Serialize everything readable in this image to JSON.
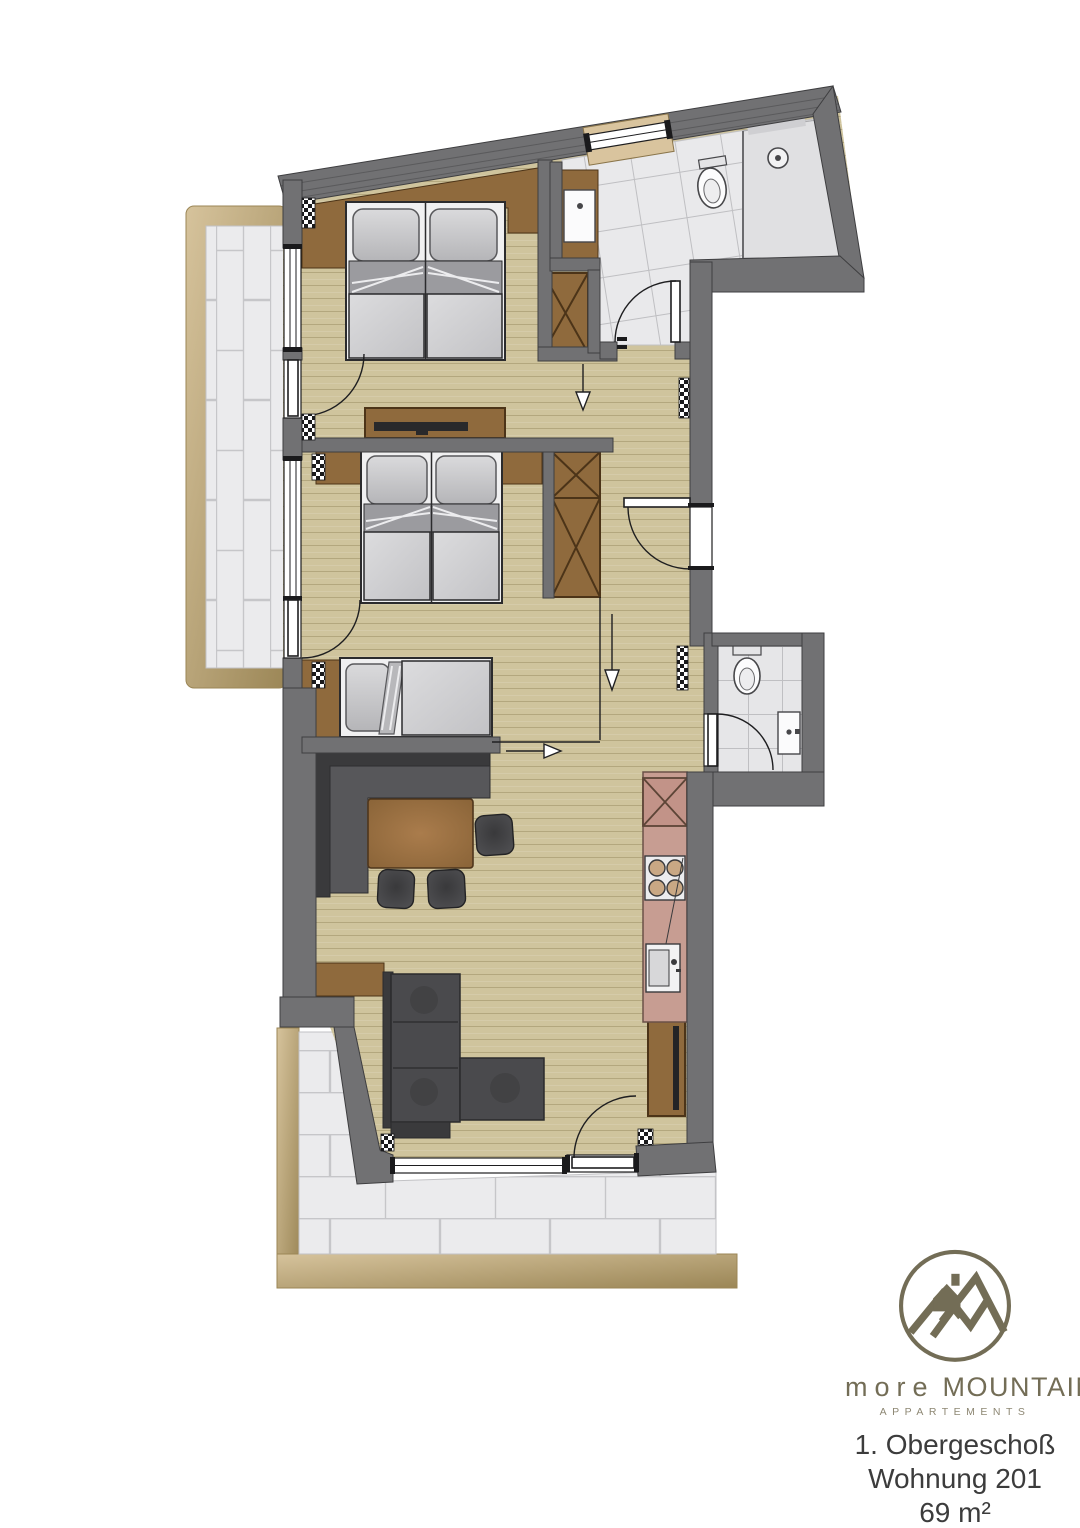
{
  "footer": {
    "floor": "1. Obergeschoß",
    "unit": "Wohnung 201",
    "area": "69 m²"
  },
  "logo": {
    "word1": "more",
    "word2": "MOUNTAIN",
    "subtitle": "APPARTEMENTS"
  },
  "colors": {
    "wall": "#717173",
    "wall_edge": "#3e3e40",
    "wood": "#cfc49d",
    "wood_line": "#b3a77e",
    "tile": "#e9e9eb",
    "tile_line": "#c2c2c5",
    "balcony_edge": "#cdb88e",
    "balcony_edge_dark": "#9b8656",
    "furniture_brown": "#8f6a3d",
    "furniture_brown_dark": "#4c3418",
    "dark_furniture": "#4a4a4d",
    "kitchen_counter": "#c79d92",
    "bed_linen": "#d3d3d5",
    "bed_sheet": "#9b9b9f",
    "logo_olive": "#736d56",
    "text_dark": "#3c3c3c"
  }
}
